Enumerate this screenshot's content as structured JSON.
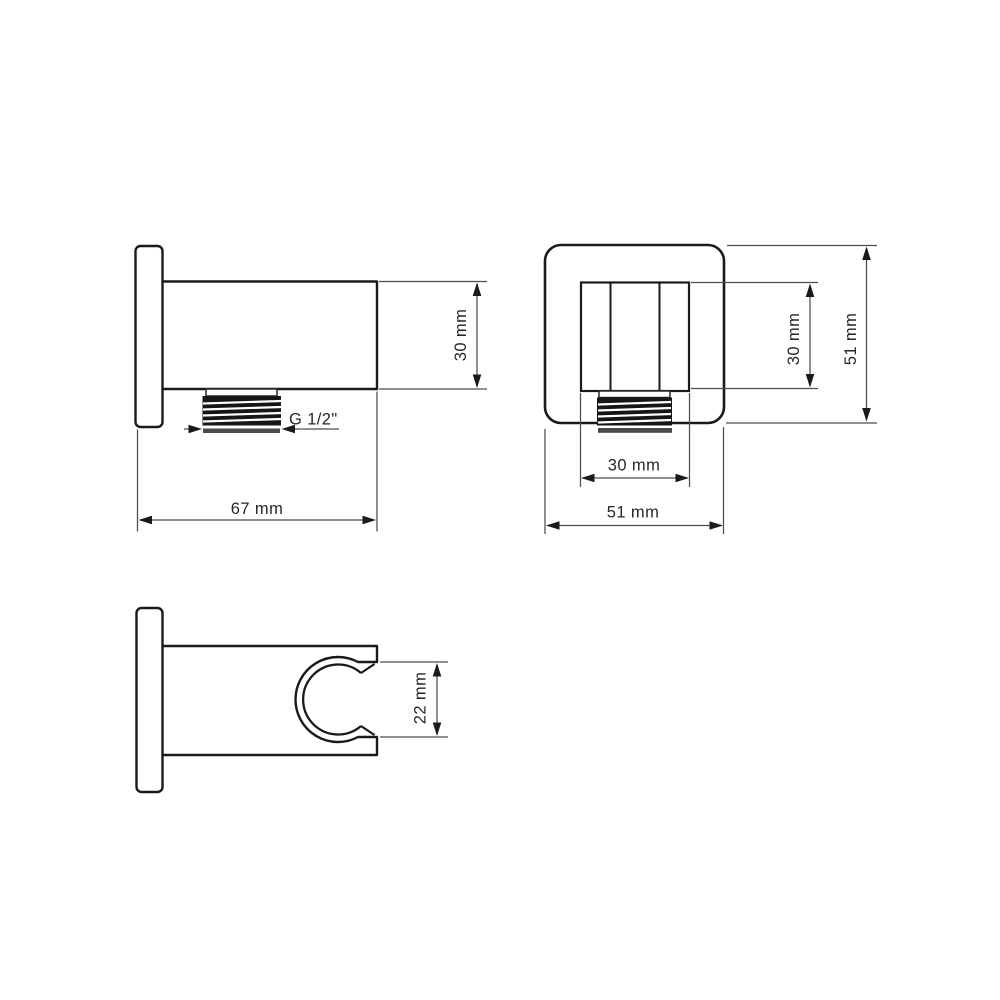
{
  "drawing": {
    "type": "technical-dimension-drawing",
    "subject": "wall-mounted shower outlet elbow and handset holder, three orthographic views",
    "side_view": {
      "height_dim": "30 mm",
      "width_dim": "67 mm",
      "thread_label": "G 1/2\""
    },
    "front_view": {
      "inner_height_dim": "30 mm",
      "outer_height_dim": "51 mm",
      "inner_width_dim": "30 mm",
      "outer_width_dim": "51 mm"
    },
    "holder_view": {
      "opening_dim": "22 mm"
    }
  },
  "colors": {
    "background": "#ffffff",
    "outline": "#1a1a1a",
    "dimension_lines": "#4d4d4d",
    "label_text": "#262626",
    "thread_fill": "#161616"
  }
}
